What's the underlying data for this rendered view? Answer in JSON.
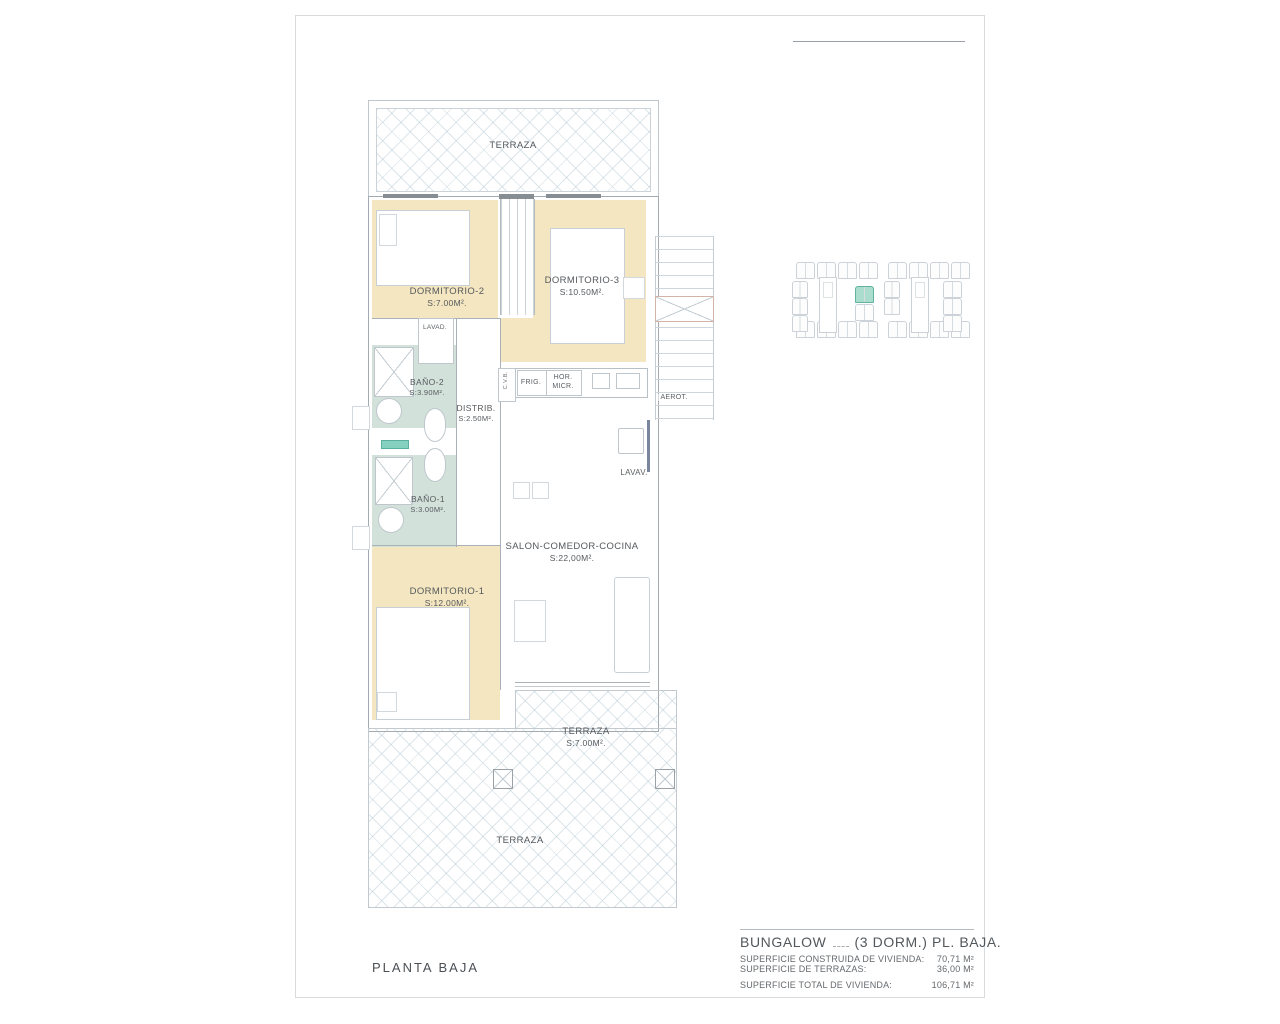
{
  "page": {
    "floor_title": "PLANTA BAJA"
  },
  "plan": {
    "terraza_top": "TERRAZA",
    "dormitorio2": {
      "name": "DORMITORIO-2",
      "area": "S:7.00M²."
    },
    "dormitorio3": {
      "name": "DORMITORIO-3",
      "area": "S:10.50M²."
    },
    "lavadero": "LAVAD.",
    "bano2": {
      "name": "BAÑO-2",
      "area": "S:3.90M²."
    },
    "distribuidor": {
      "name": "DISTRIB.",
      "area": "S:2.50M²."
    },
    "cvb": "C.V.B.",
    "frigorifico": "FRIG.",
    "horno": "HOR.",
    "microondas": "MICR.",
    "aerotermia": "AEROT.",
    "lavavajillas": "LAVAV.",
    "bano1": {
      "name": "BAÑO-1",
      "area": "S:3.00M²."
    },
    "dormitorio1": {
      "name": "DORMITORIO-1",
      "area": "S:12.00M²."
    },
    "salon": {
      "name": "SALON-COMEDOR-COCINA",
      "area": "S:22,00M²."
    },
    "terraza_salon": {
      "name": "TERRAZA",
      "area": "S:7.00M²."
    },
    "terraza_bottom": "TERRAZA"
  },
  "summary": {
    "title_name": "BUNGALOW",
    "title_rest": "(3 DORM.)  PL. BAJA.",
    "rows": [
      {
        "label": "SUPERFICIE CONSTRUIDA DE VIVIENDA:",
        "value": "70,71 M²"
      },
      {
        "label": "SUPERFICIE DE TERRAZAS:",
        "value": "36,00 M²"
      },
      {
        "label": "SUPERFICIE TOTAL DE VIVIENDA:",
        "value": "106,71 M²"
      }
    ]
  },
  "colors": {
    "room_beige": "#f4e6c0",
    "bath_teal": "#d3e1db",
    "highlight_teal": "#aaddcd"
  }
}
